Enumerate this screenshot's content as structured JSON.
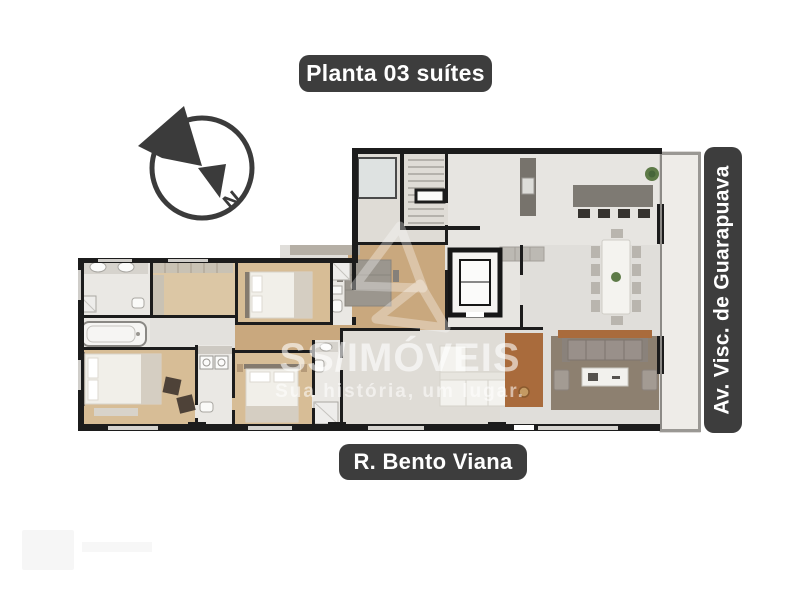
{
  "canvas": {
    "background": "#ffffff",
    "width": 800,
    "height": 600
  },
  "badges": {
    "bg_color": "#3d3d3d",
    "text_color": "#ffffff",
    "title": "Planta 03 suítes",
    "street_bottom": "R. Bento Viana",
    "street_right": "Av. Visc. de Guarapuava"
  },
  "compass": {
    "letter": "N",
    "color": "#3b3b3b"
  },
  "watermark": {
    "brand": "SS/IMÓVEIS",
    "tagline": "Sua história, um lugar.",
    "color": "#ffffff"
  },
  "floorplan": {
    "description": "Top-down architectural floor plan of a 3-suite apartment between R. Bento Viana and Av. Visc. de Guarapuava",
    "suites": "03",
    "palette": {
      "wall": "#1c1c1c",
      "wood_floor": "#c9a87e",
      "suite_floor": "#d7bd96",
      "closet_floor": "#dcc7a5",
      "tile_floor": "#eae8e4",
      "gray_floor": "#e3e1dd",
      "terrace_floor": "#eeece8",
      "rug": "#8d8070",
      "kitchen_counter": "#7e7a73",
      "wood_panel": "#a96b3c",
      "plant": "#5d7a47",
      "bed_linen": "#f1efe9",
      "dark_chair": "#4e4238"
    }
  }
}
